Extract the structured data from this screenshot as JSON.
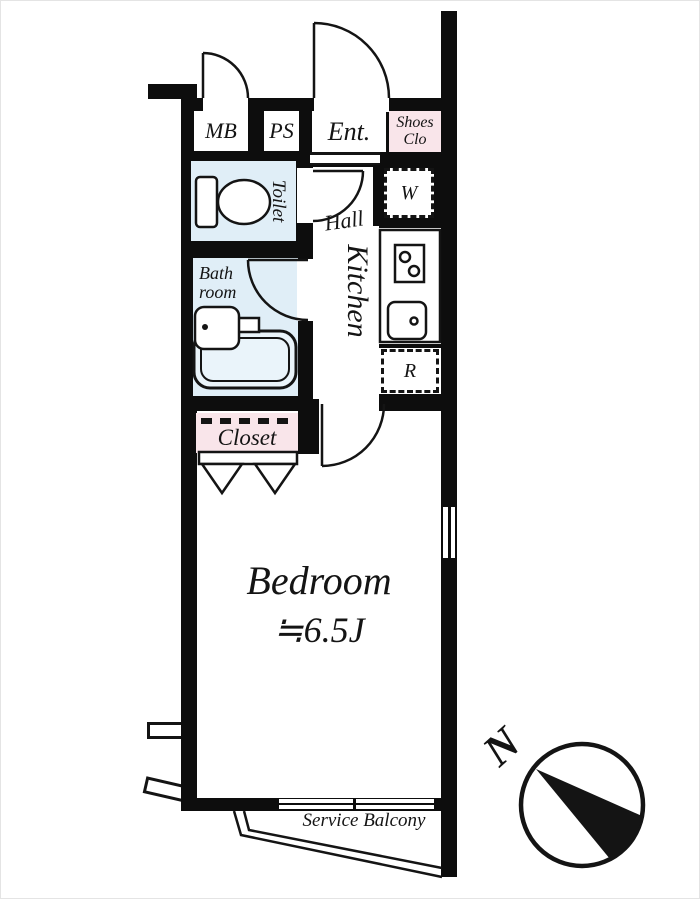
{
  "floorplan": {
    "labels": {
      "mb": "MB",
      "ps": "PS",
      "entrance": "Ent.",
      "shoes_closet": "Shoes Clo",
      "toilet": "Toilet",
      "hall": "Hall",
      "kitchen": "Kitchen",
      "washing_machine": "W",
      "refrigerator": "R",
      "bathroom": "Bath room",
      "closet": "Closet",
      "bedroom": "Bedroom",
      "bedroom_size": "≒6.5J",
      "service_balcony": "Service Balcony",
      "compass_north": "N"
    },
    "colors": {
      "wall": "#0d0d0d",
      "wet_area_blue": "#e0eef7",
      "storage_pink": "#f9e5ea",
      "line": "#141414"
    }
  }
}
